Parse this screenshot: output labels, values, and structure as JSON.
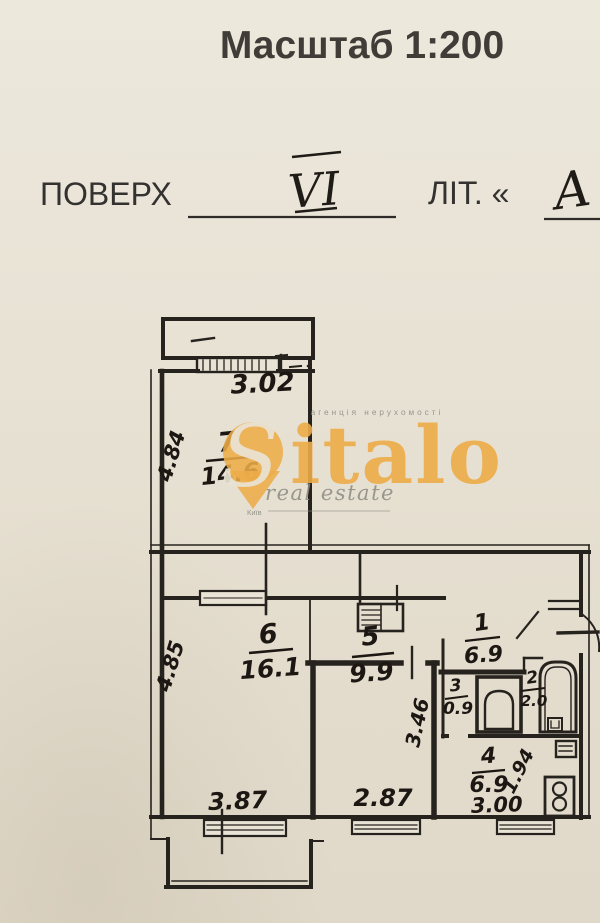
{
  "header": {
    "scale_title": "Масштаб 1:200",
    "floor_label": "ПОВЕРХ",
    "floor_value": "VI",
    "liter_label": "ЛІТ. «",
    "liter_value": "А"
  },
  "watermark": {
    "tagline": "агенція нерухомості",
    "brand_s": "S",
    "brand_rest": "italo",
    "subtitle": "real estate",
    "city": "Київ",
    "orange": "#edac48",
    "gray": "#8e8c84"
  },
  "plan": {
    "rooms": [
      {
        "number": "7",
        "area": "14.6"
      },
      {
        "number": "6",
        "area": "16.1"
      },
      {
        "number": "5",
        "area": "9.9"
      },
      {
        "number": "1",
        "area": "6.9"
      },
      {
        "number": "3",
        "area": "0.9"
      },
      {
        "number": "2",
        "area": "2.0"
      },
      {
        "number": "4",
        "area": "6.9"
      }
    ],
    "dimensions": {
      "balcony_width": "3.02",
      "room7_depth": "4.84",
      "room6_depth": "4.85",
      "room6_width": "3.87",
      "room5_width": "2.87",
      "room5_depth": "3.46",
      "kitchen_width": "3.00",
      "kitchen_depth": "1.94"
    }
  },
  "colors": {
    "paper": "#e8e2d4",
    "ink": "#26221d",
    "handwriting": "#1c1712"
  }
}
